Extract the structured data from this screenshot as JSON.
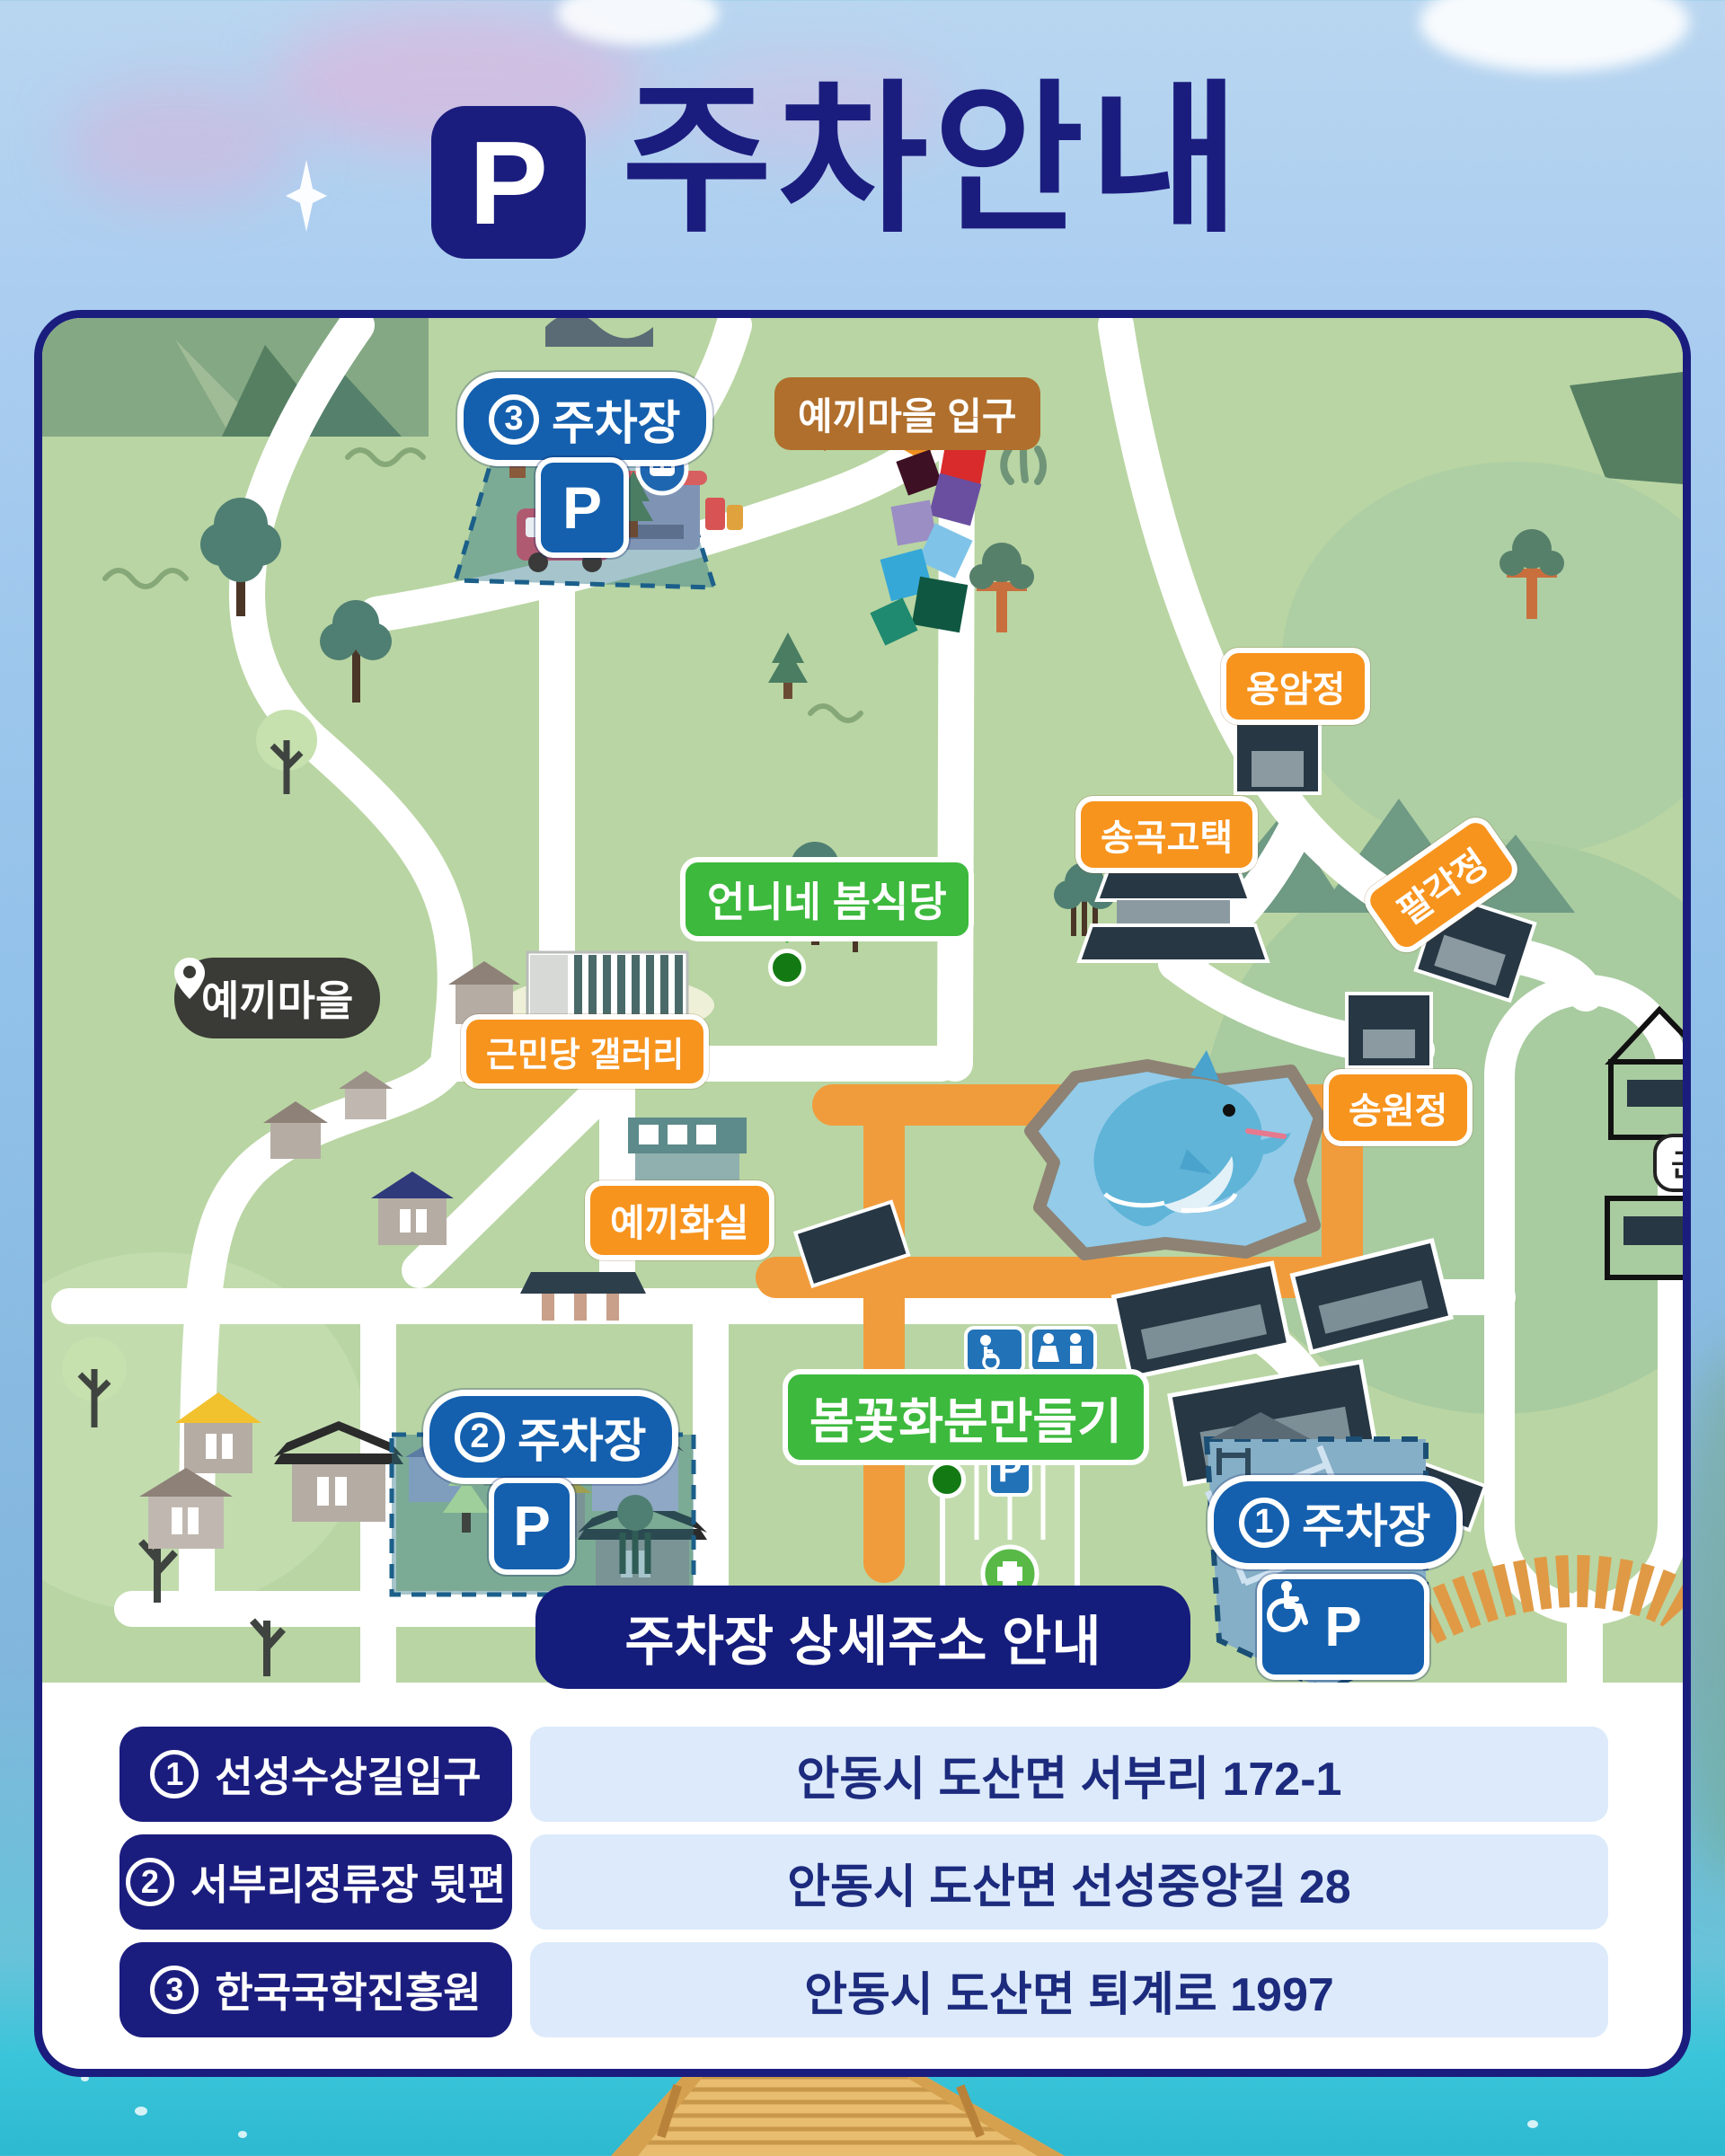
{
  "header": {
    "parking_symbol": "P",
    "title": "주차안내"
  },
  "map": {
    "parking_labels": {
      "p3": {
        "number": "3",
        "text": "주차장"
      },
      "p2": {
        "number": "2",
        "text": "주차장"
      },
      "p1": {
        "number": "1",
        "text": "주차장"
      }
    },
    "p_sign": "P",
    "entrance_bubble": "예끼마을 입구",
    "village_pill": "예끼마을",
    "orange_labels": {
      "yongamjeong": "용암정",
      "songgok": "송곡고택",
      "palgakjeong": "팔각정",
      "songwonjeong": "송원정",
      "geunmindang": "근민당 갤러리",
      "yekkihwasil": "예끼화실"
    },
    "green_labels": {
      "restaurant": "언니네 봄식당",
      "flowerpot": "봄꽃화분만들기"
    },
    "clipped_label": "군관",
    "colors": {
      "map_green": "#b9d5a3",
      "navy": "#1b1d7e",
      "label_blue": "#1460ae",
      "label_orange": "#f7941e",
      "label_green": "#3db93d",
      "label_brown": "#b06f2c",
      "path_orange": "#f19c3c",
      "pond_blue": "#93cbe9",
      "water": "#38c5da"
    }
  },
  "banner": {
    "title": "주차장 상세주소 안내"
  },
  "address_table": {
    "rows": [
      {
        "number": "1",
        "name": "선성수상길입구",
        "address": "안동시 도산면 서부리 172-1"
      },
      {
        "number": "2",
        "name": "서부리정류장 뒷편",
        "address": "안동시 도산면 선성중앙길 28"
      },
      {
        "number": "3",
        "name": "한국국학진흥원",
        "address": "안동시 도산면 퇴계로 1997"
      }
    ]
  }
}
